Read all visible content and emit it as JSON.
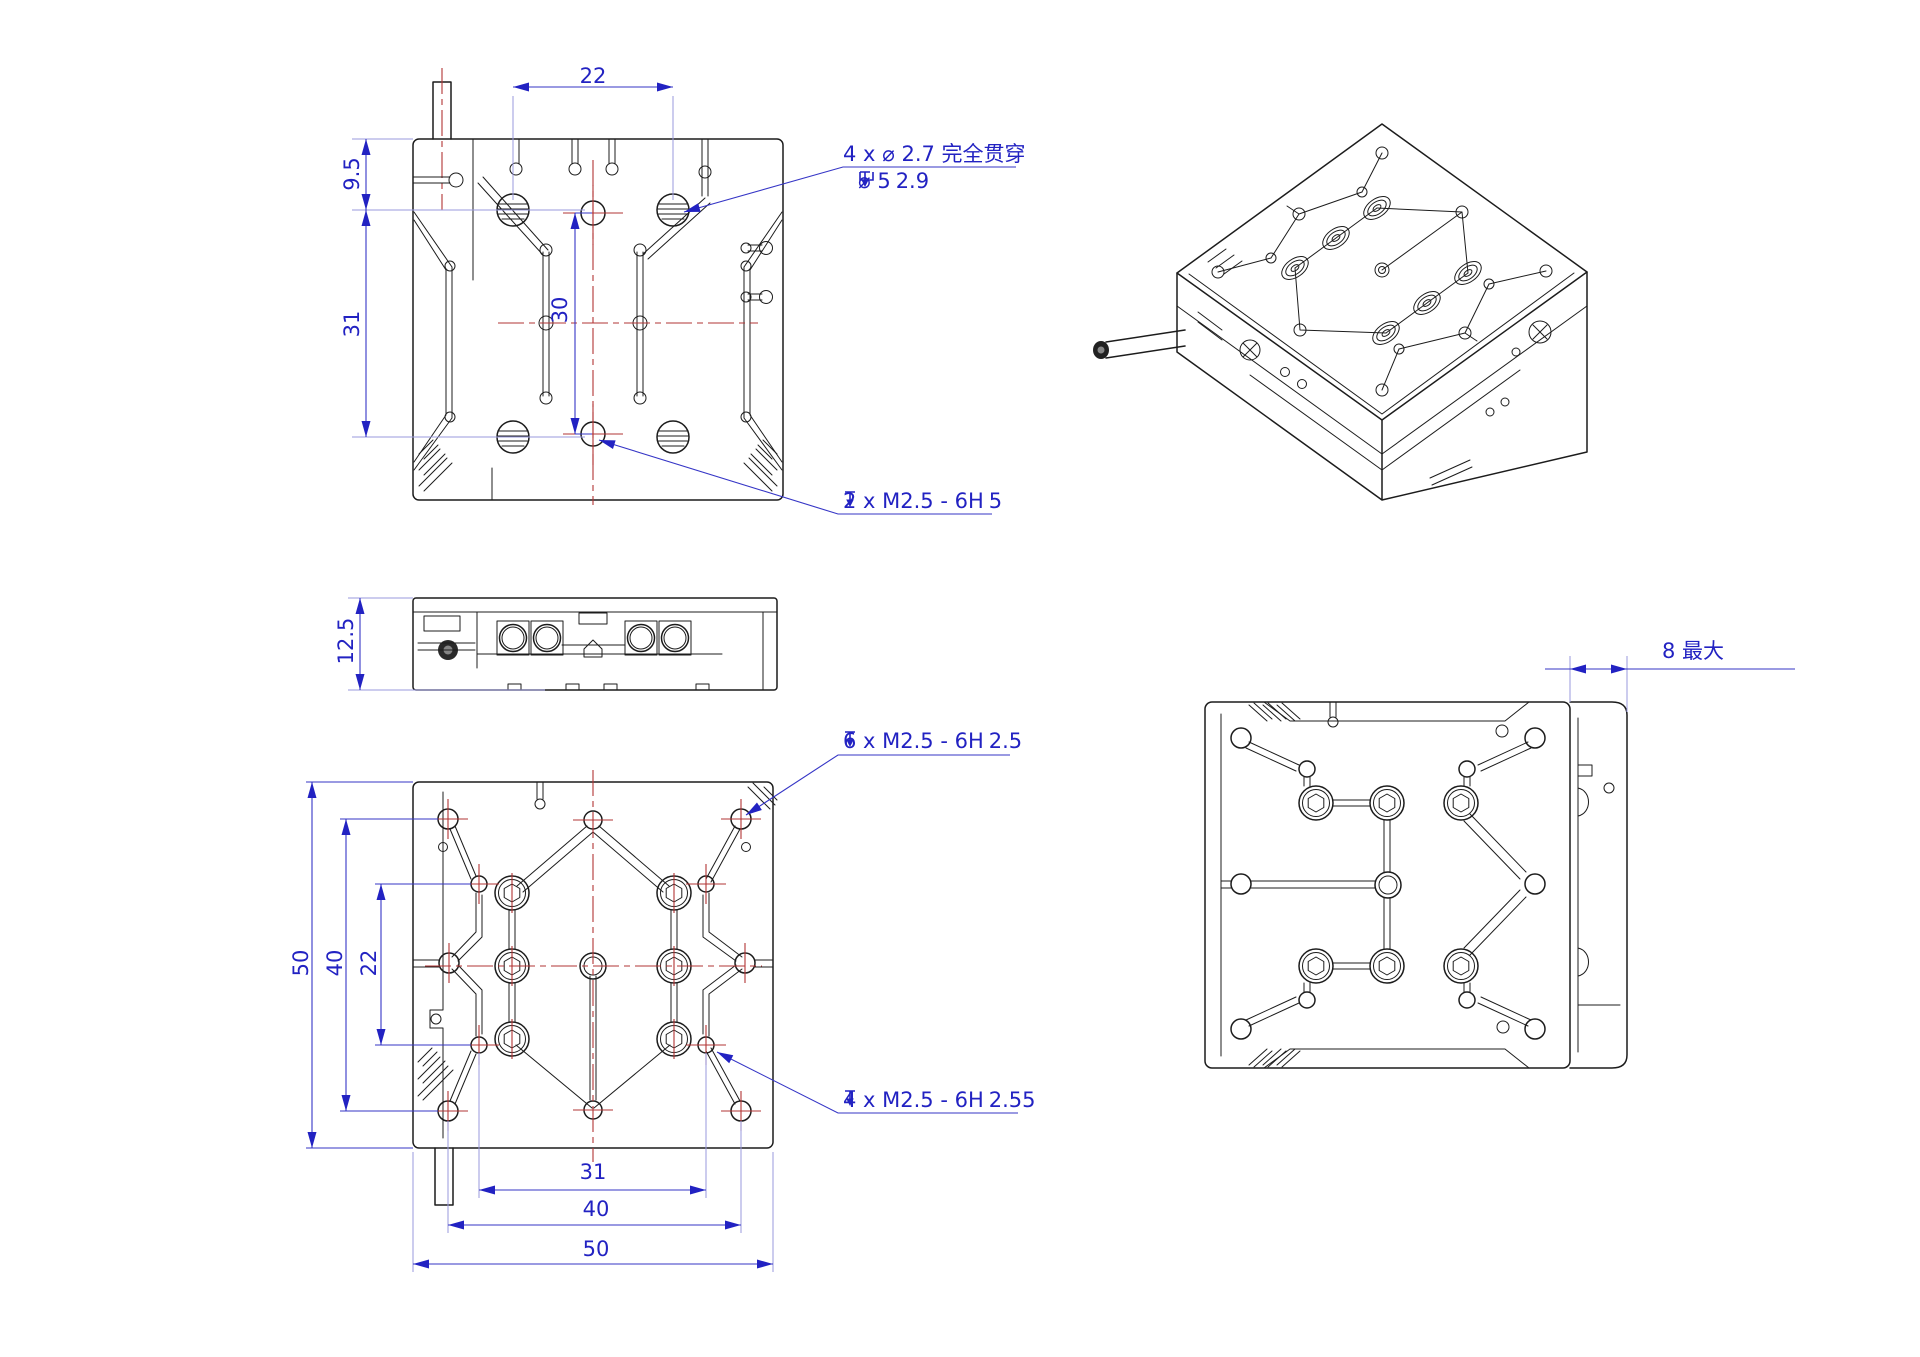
{
  "page": {
    "top_view": {
      "dim_width": "22",
      "dim_top_offset": "9.5",
      "dim_height": "31",
      "dim_hole_spacing": "30",
      "note_counterbore_line1": "4 x ⌀ 2.7 完全贯穿",
      "note_counterbore_diameter": "⌀ 5",
      "note_counterbore_depth": "2.9",
      "note_tapped_label": "2 x M2.5 - 6H",
      "note_tapped_depth": "5"
    },
    "side_view": {
      "dim_height": "12.5"
    },
    "bottom_view": {
      "dim_size_vertical": "50",
      "dim_pattern_vertical": "40",
      "dim_rows": "22",
      "dim_cols": "31",
      "dim_pattern_horizontal": "40",
      "dim_size_horizontal": "50",
      "note_tapped6_label": "6 x M2.5 - 6H",
      "note_tapped6_depth": "2.5",
      "note_tapped4_label": "4 x M2.5 - 6H",
      "note_tapped4_depth": "2.55"
    },
    "right_view": {
      "dim_max_travel": "8 最大"
    }
  }
}
